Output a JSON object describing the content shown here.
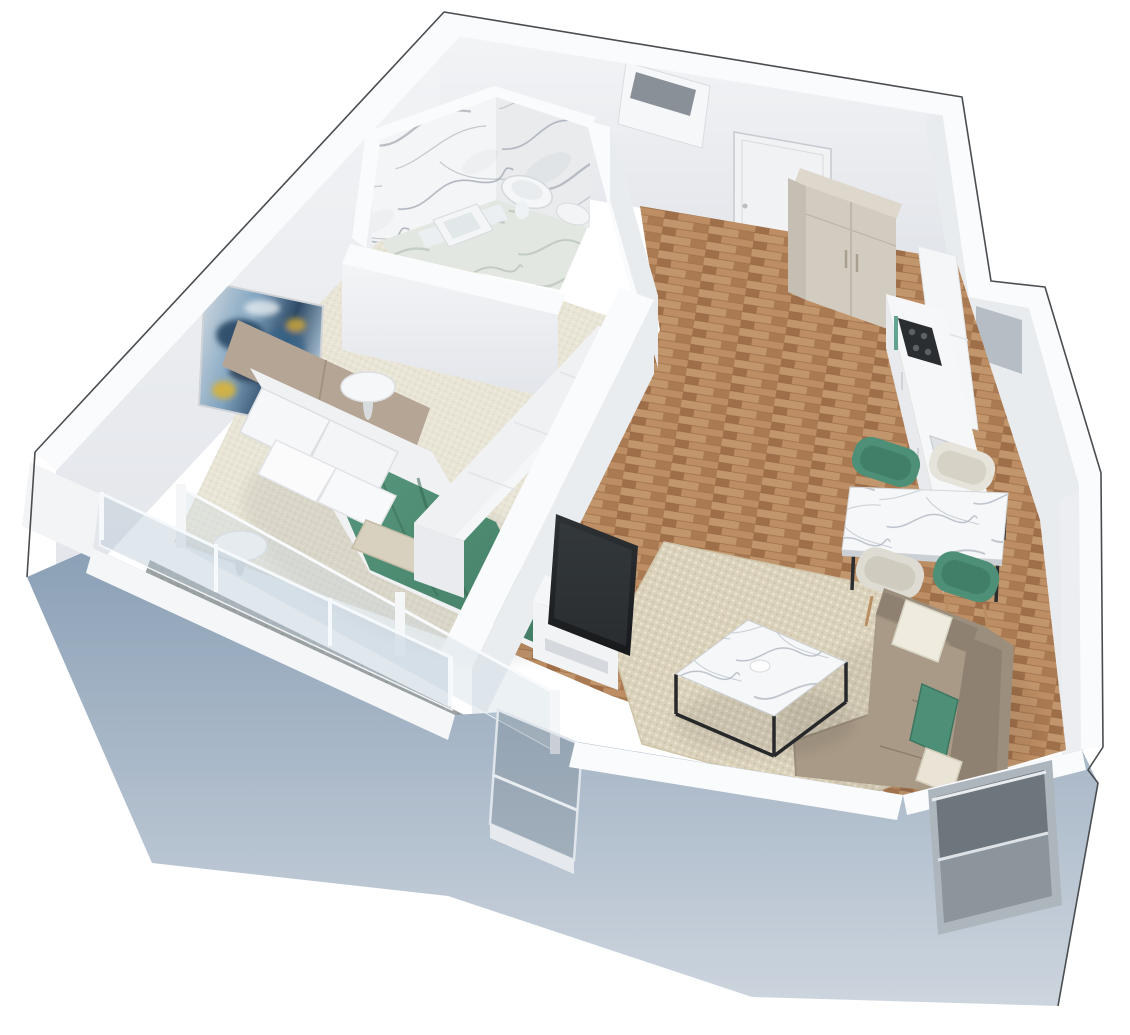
{
  "image_type": "3D isometric floor plan rendering of a one-bedroom apartment, white background, no visible text",
  "palette": {
    "background": "#ffffff",
    "outline_dark": "#4a4d50",
    "wall_top": "#fafbfc",
    "wall_face": "#eef0f3",
    "wall_face_shade": "#e5e8ec",
    "exterior_wall_blue": "#8ba0b6",
    "exterior_wall_blue_light": "#cdd5de",
    "wood_floor": "#b5875f",
    "wood_floor_dark": "#9d6f4b",
    "carpet_beige": "#e8e4d6",
    "rug_beige": "#dbd2bc",
    "balcony_stone": "#9ba1a2",
    "grate_gray": "#7c8183",
    "marble_white": "#f4f5f6",
    "marble_vein": "#8f97a3",
    "bath_floor_marble": "#e2e8e1",
    "white_furniture": "#f5f6f8",
    "white_furniture_shade": "#e9ebee",
    "green_textile": "#4e9077",
    "green_textile_dark": "#3f7a63",
    "sofa_taupe": "#9c8e7c",
    "sofa_taupe_dark": "#8f8171",
    "sofa_seat": "#a89a86",
    "headboard_taupe": "#b4a595",
    "beige_textile": "#d8d1c0",
    "wardrobe_beige": "#d2ccc0",
    "wardrobe_beige_dark": "#c5bfb3",
    "wardrobe_beige_light": "#ded8cc",
    "window_recess_gray": "#b6bdc5",
    "tv_black": "#232629",
    "chair_cream": "#e6e3da",
    "chair_leg_wood": "#b98f62",
    "glass_tint": "rgba(196,210,221,0.42)"
  },
  "scene": {
    "rooms": [
      {
        "name": "Bathroom",
        "position": "top-left",
        "features": [
          "marble-clad walls",
          "wall-hung toilet",
          "bidet",
          "square vessel sink",
          "green-gray marble floor"
        ]
      },
      {
        "name": "Bedroom",
        "position": "left",
        "features": [
          "double bed with taupe upholstered headboard",
          "white bedding and four pillows",
          "sage green throw blanket",
          "beige accent pillow",
          "abstract blue-gold wall art",
          "two round white side tables",
          "long low white dresser",
          "beige carpet",
          "glass sliding doors to balcony"
        ]
      },
      {
        "name": "Hallway",
        "position": "top-center",
        "features": [
          "entrance door",
          "ventilation shaft box",
          "beige two-door wardrobe",
          "wood parquet floor"
        ]
      },
      {
        "name": "Kitchen",
        "position": "right",
        "features": [
          "white upper cabinets",
          "white base cabinets with counter",
          "black gas hob",
          "sink",
          "window recess in wall"
        ]
      },
      {
        "name": "Living room",
        "position": "center-right",
        "features": [
          "beige woven area rug",
          "marble coffee table with black metal frame",
          "taupe corner sofa",
          "white, green and beige throw pillows",
          "marble dining table with black legs",
          "two green dining chairs",
          "two cream dining chairs",
          "TV on white media unit",
          "corner window behind sofa"
        ]
      },
      {
        "name": "Balcony",
        "position": "bottom-left",
        "features": [
          "gray stone floor",
          "drainage grate strip",
          "glass balustrade",
          "white parapet"
        ]
      }
    ],
    "exterior": {
      "wall_faces": "light blue-gray",
      "wall_tops": "white",
      "silhouette_outline": "thin dark line"
    }
  }
}
